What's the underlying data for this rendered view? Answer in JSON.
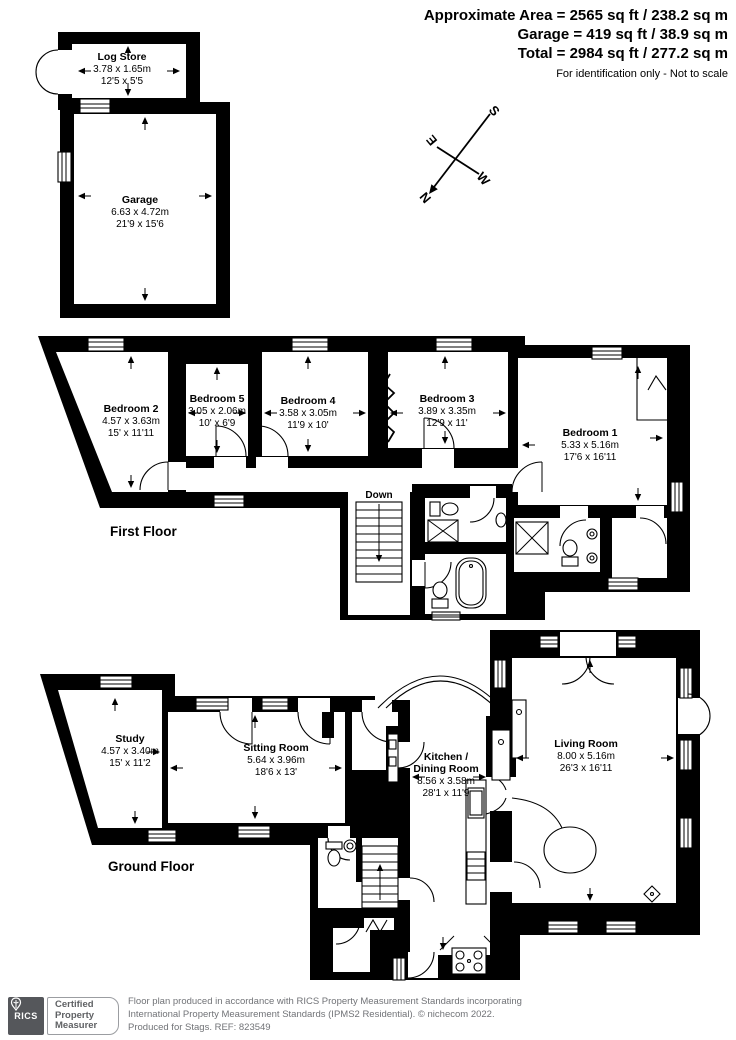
{
  "header": {
    "line1": "Approximate Area = 2565 sq ft / 238.2 sq m",
    "line2": "Garage = 419 sq ft / 38.9 sq m",
    "line3": "Total = 2984 sq ft / 277.2 sq m",
    "note": "For identification only - Not to scale"
  },
  "compass": {
    "n": "N",
    "e": "E",
    "s": "S",
    "w": "W"
  },
  "floors": {
    "first": "First Floor",
    "ground": "Ground Floor"
  },
  "stairs": {
    "down": "Down",
    "up": "Up"
  },
  "rooms": {
    "log_store": {
      "name": "Log Store",
      "metric": "3.78 x 1.65m",
      "imperial": "12'5 x 5'5"
    },
    "garage": {
      "name": "Garage",
      "metric": "6.63 x 4.72m",
      "imperial": "21'9 x 15'6"
    },
    "bedroom2": {
      "name": "Bedroom 2",
      "metric": "4.57 x 3.63m",
      "imperial": "15' x 11'11"
    },
    "bedroom5": {
      "name": "Bedroom 5",
      "metric": "3.05 x 2.06m",
      "imperial": "10' x 6'9"
    },
    "bedroom4": {
      "name": "Bedroom 4",
      "metric": "3.58 x 3.05m",
      "imperial": "11'9 x 10'"
    },
    "bedroom3": {
      "name": "Bedroom 3",
      "metric": "3.89 x 3.35m",
      "imperial": "12'9 x 11'"
    },
    "bedroom1": {
      "name": "Bedroom 1",
      "metric": "5.33 x 5.16m",
      "imperial": "17'6 x 16'11"
    },
    "study": {
      "name": "Study",
      "metric": "4.57 x 3.40m",
      "imperial": "15' x 11'2"
    },
    "sitting_room": {
      "name": "Sitting Room",
      "metric": "5.64 x 3.96m",
      "imperial": "18'6 x 13'"
    },
    "kitchen": {
      "name_line1": "Kitchen /",
      "name_line2": "Dining Room",
      "metric": "8.56 x 3.58m",
      "imperial": "28'1 x 11'9"
    },
    "living_room": {
      "name": "Living Room",
      "metric": "8.00 x 5.16m",
      "imperial": "26'3 x 16'11"
    }
  },
  "footer": {
    "rics_label": "RICS",
    "badge_line1": "Certified",
    "badge_line2": "Property",
    "badge_line3": "Measurer",
    "line1": "Floor plan produced in accordance with RICS Property Measurement Standards incorporating",
    "line2": "International Property Measurement Standards (IPMS2 Residential).   © nichecom 2022.",
    "line3": "Produced for Stags.   REF: 823549"
  }
}
